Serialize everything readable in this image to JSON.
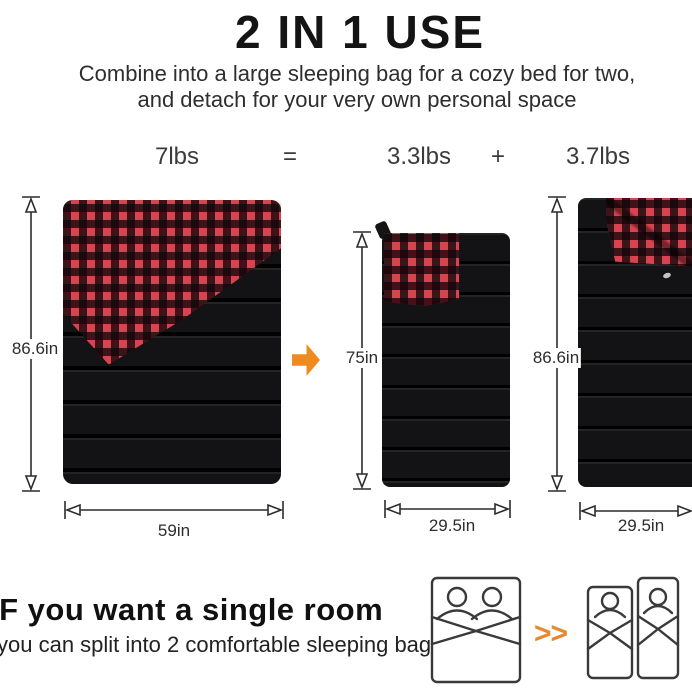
{
  "header": {
    "title": "2 IN 1 USE",
    "subtitle_line1": "Combine into a large sleeping bag for a cozy bed for two,",
    "subtitle_line2": "and detach for your very own personal space"
  },
  "equation": {
    "total_weight": "7lbs",
    "equals_sign": "=",
    "bag_a_weight": "3.3lbs",
    "plus_sign": "+",
    "bag_b_weight": "3.7lbs"
  },
  "dimensions": {
    "double_bag": {
      "height": "86.6in",
      "width": "59in"
    },
    "single_bag_folded": {
      "height": "75in",
      "width": "29.5in"
    },
    "single_bag_full": {
      "height": "86.6in",
      "width": "29.5in"
    }
  },
  "footer": {
    "heading": "IF you want a single room",
    "subheading": "you can split into 2 comfortable sleeping bag",
    "chevrons": ">>"
  },
  "colors": {
    "accent_orange": "#ee8a20",
    "plaid_red": "#d7434f",
    "bag_black": "#131316",
    "dimension_line": "#2c2c2c",
    "icon_stroke": "#3a3a3a"
  }
}
